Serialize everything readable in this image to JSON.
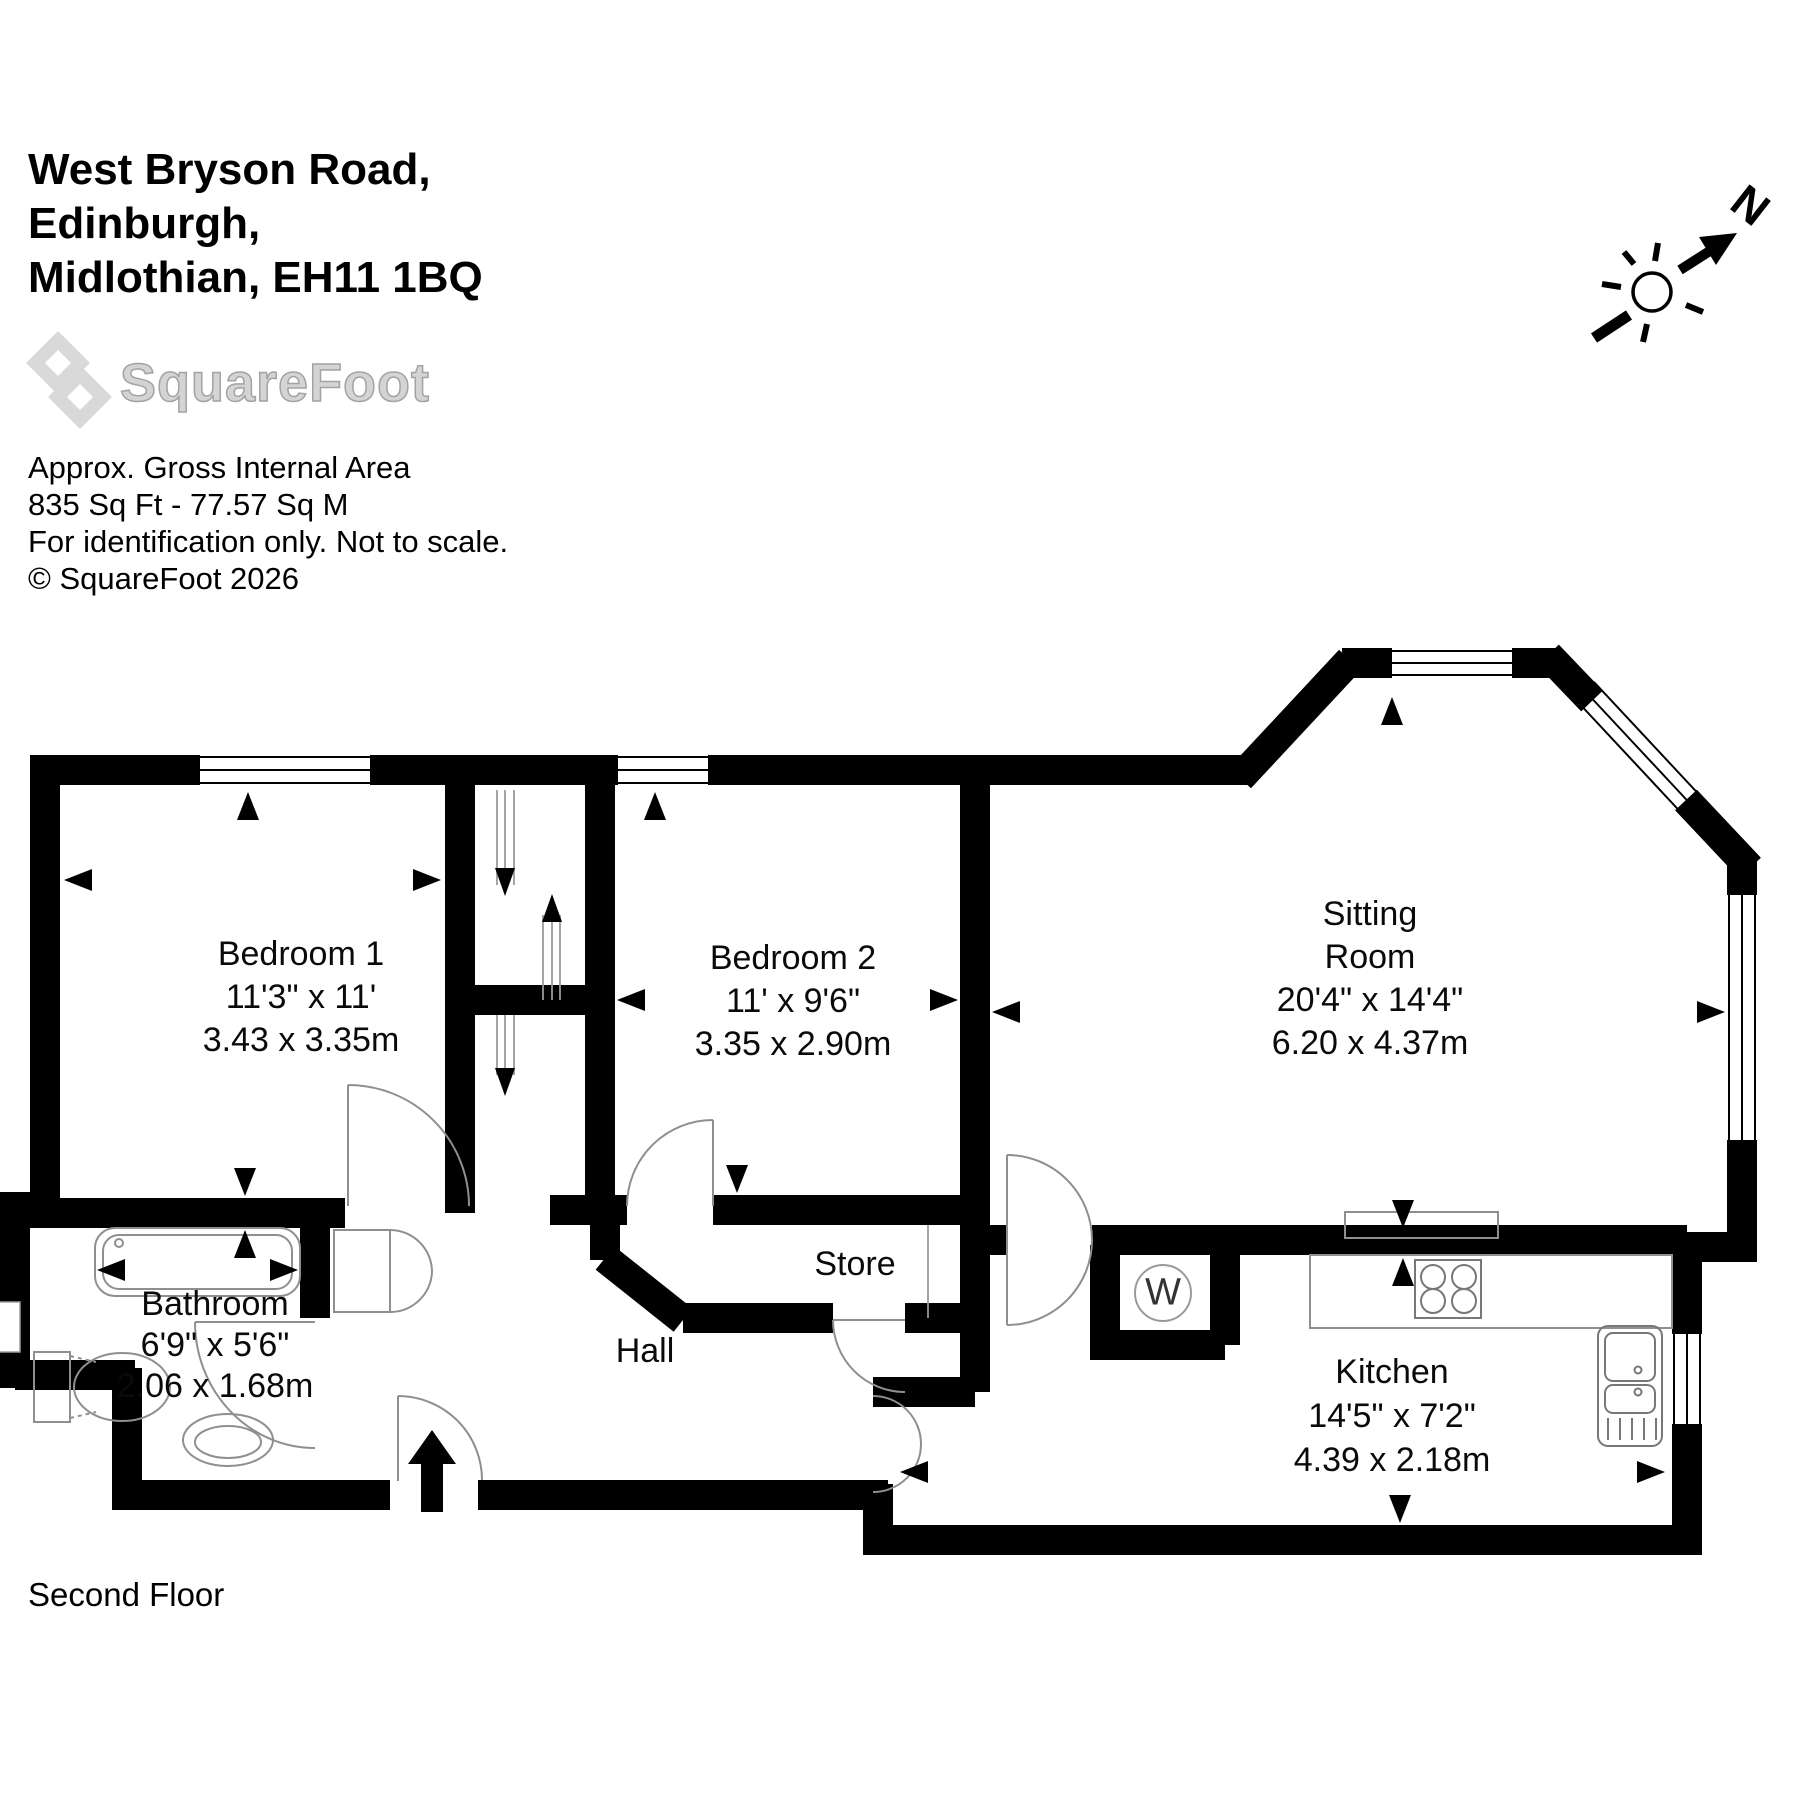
{
  "header": {
    "address_line1": "West Bryson Road,",
    "address_line2": "Edinburgh,",
    "address_line3": "Midlothian, EH11 1BQ",
    "logo_text": "SquareFoot",
    "area_title": "Approx. Gross Internal Area",
    "area_value": "835 Sq Ft  -  77.57 Sq M",
    "area_note": "For identification only. Not to scale.",
    "copyright": "© SquareFoot 2026"
  },
  "floor_label": "Second Floor",
  "compass": {
    "north_label": "N"
  },
  "rooms": {
    "bedroom1": {
      "name": "Bedroom 1",
      "dims_imperial": "11'3\" x 11'",
      "dims_metric": "3.43 x 3.35m"
    },
    "bedroom2": {
      "name": "Bedroom 2",
      "dims_imperial": "11' x 9'6\"",
      "dims_metric": "3.35 x 2.90m"
    },
    "sitting_room": {
      "name_line1": "Sitting",
      "name_line2": "Room",
      "dims_imperial": "20'4\" x 14'4\"",
      "dims_metric": "6.20 x 4.37m"
    },
    "bathroom": {
      "name": "Bathroom",
      "dims_imperial": "6'9\" x 5'6\"",
      "dims_metric": "2.06 x 1.68m"
    },
    "hall": {
      "name": "Hall"
    },
    "store": {
      "name": "Store"
    },
    "kitchen": {
      "name": "Kitchen",
      "dims_imperial": "14'5\" x 7'2\"",
      "dims_metric": "4.39 x 2.18m"
    }
  },
  "appliances": {
    "washing_machine_label": "W"
  },
  "colors": {
    "wall": "#000000",
    "fixture": "#8f8f8f",
    "logo_gray": "#d9d9d9"
  }
}
